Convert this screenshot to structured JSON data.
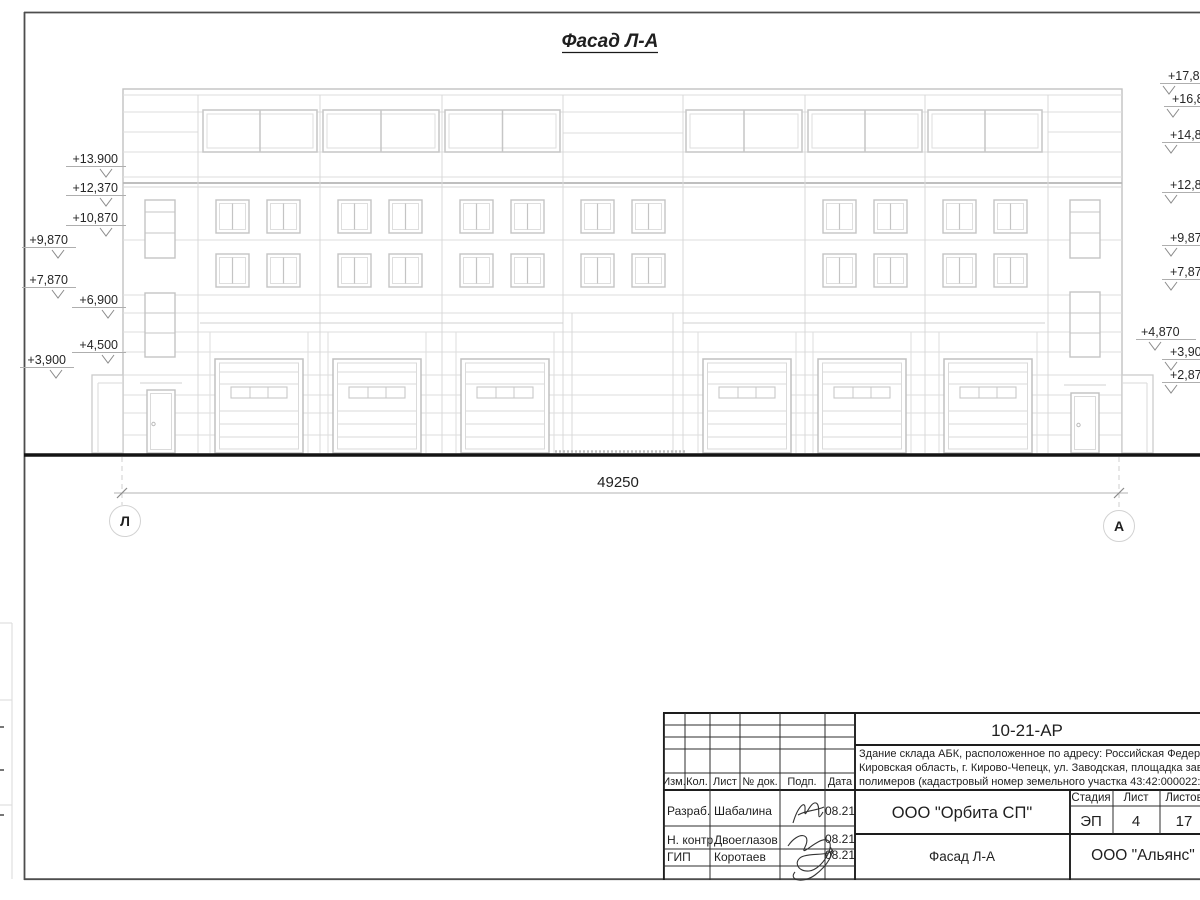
{
  "sheet": {
    "title": "Фасад Л-А",
    "dimension": "49250",
    "axis_left": "Л",
    "axis_right": "А"
  },
  "levels_left": [
    {
      "text": "+13.900"
    },
    {
      "text": "+12,370"
    },
    {
      "text": "+10,870"
    },
    {
      "text": "+9,870"
    },
    {
      "text": "+7,870"
    },
    {
      "text": "+6,900"
    },
    {
      "text": "+4,500"
    },
    {
      "text": "+3,900"
    }
  ],
  "levels_right": [
    {
      "text": "+17,870"
    },
    {
      "text": "+16,870"
    },
    {
      "text": "+14,870"
    },
    {
      "text": "+12,870"
    },
    {
      "text": "+9,870"
    },
    {
      "text": "+7,870"
    },
    {
      "text": "+4,870"
    },
    {
      "text": "+3,900"
    },
    {
      "text": "+2,870"
    }
  ],
  "title_block": {
    "doc_number": "10-21-АР",
    "description_line1": "Здание склада АБК, расположенное по адресу: Российская Федерация,",
    "description_line2": "Кировская область, г. Кирово-Чепецк, ул. Заводская, площадка завода",
    "description_line3": "полимеров (кадастровый номер земельного участка 43:42:000022:",
    "col_izm": "Изм.",
    "col_kol": "Кол.",
    "col_list": "Лист",
    "col_doc": "№ док.",
    "col_sign": "Подп.",
    "col_date": "Дата",
    "row1_role": "Разраб.",
    "row1_name": "Шабалина",
    "row1_date": "08.21",
    "row2_role": "Н. контр.",
    "row2_name": "Двоеглазов",
    "row2_date": "08.21",
    "row3_role": "ГИП",
    "row3_name": "Коротаев",
    "row3_date": "08.21",
    "org": "ООО \"Орбита СП\"",
    "stage_label": "Стадия",
    "sheet_label": "Лист",
    "sheets_label": "Листов",
    "stage": "ЭП",
    "sheet_num": "4",
    "sheets_total": "17",
    "drawing_title": "Фасад Л-А",
    "company": "ООО \"Альянс\""
  }
}
